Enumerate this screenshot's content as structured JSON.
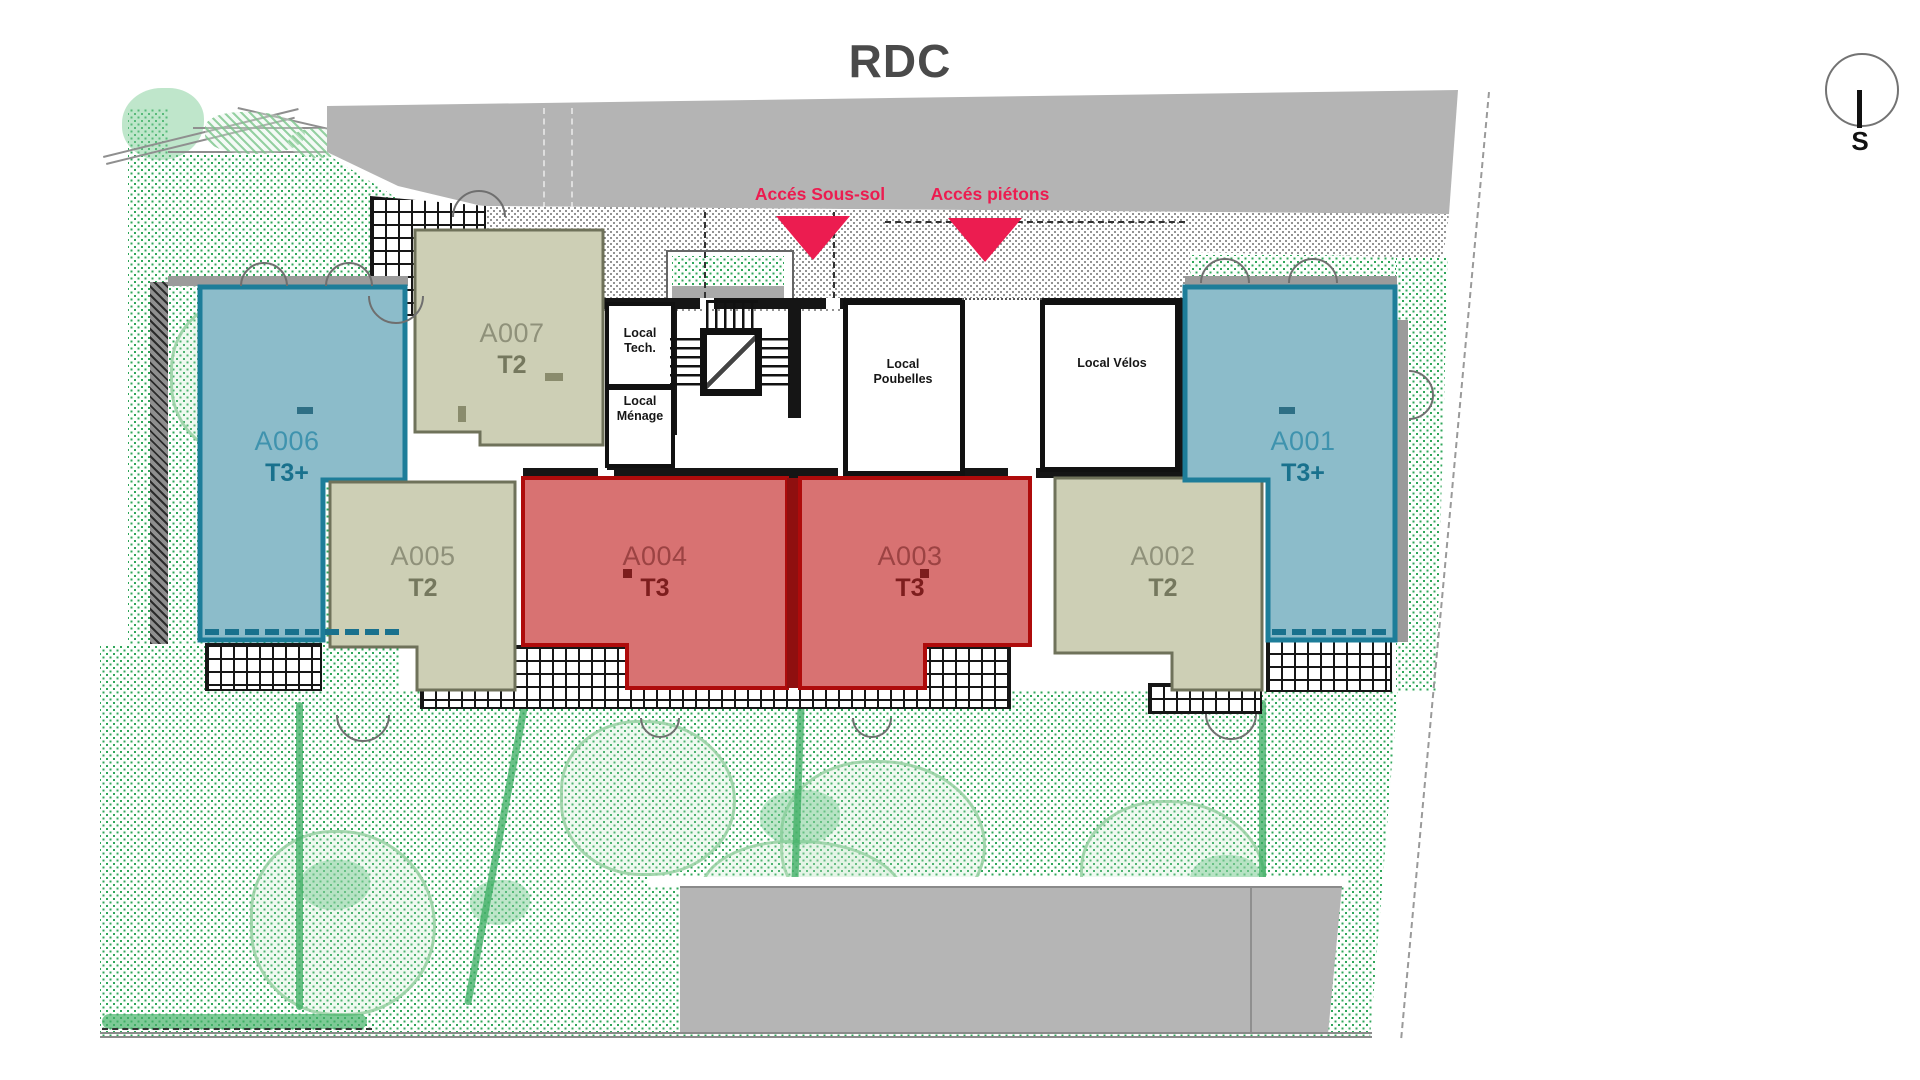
{
  "title": "RDC",
  "compass": {
    "label": "S"
  },
  "access": {
    "sous_sol": "Accés Sous-sol",
    "pietons": "Accés piétons"
  },
  "apartments": [
    {
      "id": "A001",
      "type": "T3+",
      "category": "teal"
    },
    {
      "id": "A002",
      "type": "T2",
      "category": "olive"
    },
    {
      "id": "A003",
      "type": "T3",
      "category": "red"
    },
    {
      "id": "A004",
      "type": "T3",
      "category": "red"
    },
    {
      "id": "A005",
      "type": "T2",
      "category": "olive"
    },
    {
      "id": "A006",
      "type": "T3+",
      "category": "teal"
    },
    {
      "id": "A007",
      "type": "T2",
      "category": "olive"
    }
  ],
  "locals": [
    {
      "name": "Local Tech."
    },
    {
      "name": "Local Ménage"
    },
    {
      "name": "Local Poubelles"
    },
    {
      "name": "Local Vélos"
    }
  ],
  "colors": {
    "teal_fill": "#8cbcca",
    "teal_border": "#1d7d99",
    "olive_fill": "#cdcfb5",
    "olive_border": "#6f725a",
    "red_fill": "#d87272",
    "red_border": "#ae0b0b",
    "accent_red": "#ec1c50",
    "road_gray": "#b4b4b4",
    "parking_gray": "#b5b5b5",
    "garden_dot_green": "#2fa65a"
  }
}
